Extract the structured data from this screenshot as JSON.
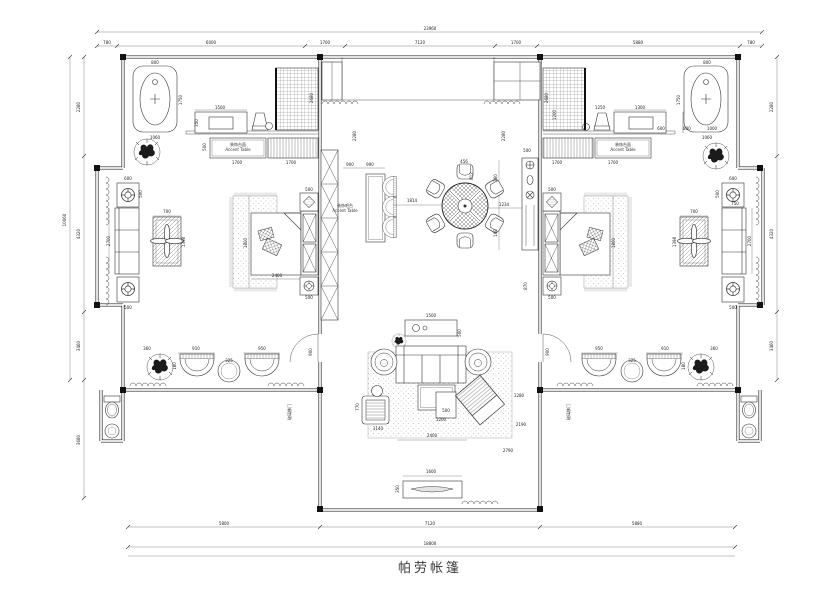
{
  "title": {
    "text": "帕劳帐篷"
  },
  "colors": {
    "ink": "#1c1c1c",
    "dim_text": "#222"
  },
  "annotations": [
    {
      "t": "23960",
      "x": 430,
      "y": 30
    },
    {
      "t": "780",
      "x": 107,
      "y": 44
    },
    {
      "t": "6000",
      "x": 211,
      "y": 44
    },
    {
      "t": "1700",
      "x": 325,
      "y": 44
    },
    {
      "t": "7120",
      "x": 420,
      "y": 44
    },
    {
      "t": "1700",
      "x": 516,
      "y": 44
    },
    {
      "t": "5880",
      "x": 638,
      "y": 44
    },
    {
      "t": "780",
      "x": 751,
      "y": 44
    },
    {
      "t": "5800",
      "x": 224,
      "y": 525
    },
    {
      "t": "7120",
      "x": 430,
      "y": 525
    },
    {
      "t": "5880",
      "x": 637,
      "y": 525
    },
    {
      "t": "18800",
      "x": 430,
      "y": 545
    },
    {
      "t": "10060",
      "x": 66,
      "y": 220,
      "r": -90
    },
    {
      "t": "2280",
      "x": 80,
      "y": 107,
      "r": -90
    },
    {
      "t": "4320",
      "x": 80,
      "y": 234,
      "r": -90
    },
    {
      "t": "3460",
      "x": 80,
      "y": 346,
      "r": -90
    },
    {
      "t": "3680",
      "x": 80,
      "y": 440,
      "r": -90
    },
    {
      "t": "2280",
      "x": 773,
      "y": 107,
      "r": -90
    },
    {
      "t": "4320",
      "x": 773,
      "y": 234,
      "r": -90
    },
    {
      "t": "3460",
      "x": 773,
      "y": 346,
      "r": -90
    },
    {
      "t": "800",
      "x": 155,
      "y": 64
    },
    {
      "t": "1750",
      "x": 182,
      "y": 100,
      "r": -90
    },
    {
      "t": "1060",
      "x": 155,
      "y": 139
    },
    {
      "t": "1500",
      "x": 220,
      "y": 109
    },
    {
      "t": "350",
      "x": 198,
      "y": 123,
      "r": -90
    },
    {
      "t": "2680",
      "x": 313,
      "y": 98,
      "r": -90
    },
    {
      "t": "500",
      "x": 206,
      "y": 147,
      "r": -90
    },
    {
      "t": "1700",
      "x": 237,
      "y": 164
    },
    {
      "t": "1700",
      "x": 291,
      "y": 164
    },
    {
      "t": "装饰台面",
      "x": 238,
      "y": 146,
      "s": 4,
      "c": "lbl"
    },
    {
      "t": "Accent Table",
      "x": 238,
      "y": 151,
      "s": 3.2,
      "c": "lbl"
    },
    {
      "t": "800",
      "x": 707,
      "y": 64
    },
    {
      "t": "1750",
      "x": 680,
      "y": 100,
      "r": -90
    },
    {
      "t": "1060",
      "x": 707,
      "y": 139
    },
    {
      "t": "1300",
      "x": 640,
      "y": 109
    },
    {
      "t": "1250",
      "x": 600,
      "y": 109
    },
    {
      "t": "600",
      "x": 661,
      "y": 130
    },
    {
      "t": "800",
      "x": 687,
      "y": 130
    },
    {
      "t": "1000",
      "x": 712,
      "y": 130
    },
    {
      "t": "2680",
      "x": 548,
      "y": 98,
      "r": -90
    },
    {
      "t": "1200",
      "x": 556,
      "y": 115,
      "r": -90
    },
    {
      "t": "1700",
      "x": 557,
      "y": 164
    },
    {
      "t": "1700",
      "x": 613,
      "y": 164
    },
    {
      "t": "装饰台面",
      "x": 623,
      "y": 146,
      "s": 4,
      "c": "lbl"
    },
    {
      "t": "Accent Table",
      "x": 623,
      "y": 151,
      "s": 3.2,
      "c": "lbl"
    },
    {
      "t": "500",
      "x": 309,
      "y": 191
    },
    {
      "t": "500",
      "x": 309,
      "y": 299
    },
    {
      "t": "1800",
      "x": 247,
      "y": 243,
      "r": -90
    },
    {
      "t": "2400",
      "x": 277,
      "y": 277
    },
    {
      "t": "500",
      "x": 552,
      "y": 191
    },
    {
      "t": "500",
      "x": 552,
      "y": 299
    },
    {
      "t": "1800",
      "x": 615,
      "y": 243,
      "r": -90
    },
    {
      "t": "870",
      "x": 527,
      "y": 286,
      "r": -90
    },
    {
      "t": "2280",
      "x": 356,
      "y": 136,
      "r": -90
    },
    {
      "t": "2280",
      "x": 505,
      "y": 136,
      "r": -90
    },
    {
      "t": "900",
      "x": 350,
      "y": 166
    },
    {
      "t": "990",
      "x": 370,
      "y": 166
    },
    {
      "t": "1814",
      "x": 412,
      "y": 202
    },
    {
      "t": "456",
      "x": 464,
      "y": 163
    },
    {
      "t": "812",
      "x": 473,
      "y": 176,
      "r": -90
    },
    {
      "t": "500",
      "x": 527,
      "y": 152
    },
    {
      "t": "160",
      "x": 497,
      "y": 178,
      "r": -90
    },
    {
      "t": "1234",
      "x": 504,
      "y": 206
    },
    {
      "t": "160",
      "x": 497,
      "y": 233,
      "r": -90
    },
    {
      "t": "装饰吧台",
      "x": 345,
      "y": 207,
      "s": 3.5,
      "c": "lbl"
    },
    {
      "t": "Accent Table",
      "x": 345,
      "y": 212,
      "s": 3,
      "c": "lbl"
    },
    {
      "t": "1500",
      "x": 431,
      "y": 317
    },
    {
      "t": "500",
      "x": 461,
      "y": 333,
      "r": -90
    },
    {
      "t": "1200",
      "x": 441,
      "y": 421
    },
    {
      "t": "500",
      "x": 446,
      "y": 412
    },
    {
      "t": "2400",
      "x": 432,
      "y": 437
    },
    {
      "t": "2190",
      "x": 521,
      "y": 426
    },
    {
      "t": "1280",
      "x": 519,
      "y": 397
    },
    {
      "t": "2790",
      "x": 508,
      "y": 452
    },
    {
      "t": "770",
      "x": 359,
      "y": 407,
      "r": -90
    },
    {
      "t": "1140",
      "x": 378,
      "y": 430
    },
    {
      "t": "1600",
      "x": 431,
      "y": 473
    },
    {
      "t": "350",
      "x": 399,
      "y": 489,
      "r": -90
    },
    {
      "t": "360",
      "x": 147,
      "y": 350
    },
    {
      "t": "910",
      "x": 196,
      "y": 350
    },
    {
      "t": "950",
      "x": 262,
      "y": 350
    },
    {
      "t": "325",
      "x": 229,
      "y": 362
    },
    {
      "t": "180",
      "x": 176,
      "y": 366,
      "r": -90
    },
    {
      "t": "900",
      "x": 312,
      "y": 352,
      "r": -90
    },
    {
      "t": "玻璃移门",
      "x": 291,
      "y": 412,
      "r": -90,
      "s": 3.5,
      "c": "lbl"
    },
    {
      "t": "360",
      "x": 714,
      "y": 350
    },
    {
      "t": "910",
      "x": 665,
      "y": 350
    },
    {
      "t": "950",
      "x": 599,
      "y": 350
    },
    {
      "t": "325",
      "x": 632,
      "y": 362
    },
    {
      "t": "180",
      "x": 685,
      "y": 366,
      "r": -90
    },
    {
      "t": "900",
      "x": 549,
      "y": 352,
      "r": -90
    },
    {
      "t": "玻璃移门",
      "x": 570,
      "y": 412,
      "r": -90,
      "s": 3.5,
      "c": "lbl"
    },
    {
      "t": "600",
      "x": 128,
      "y": 180
    },
    {
      "t": "500",
      "x": 142,
      "y": 194,
      "r": -90
    },
    {
      "t": "2700",
      "x": 110,
      "y": 241,
      "r": -90
    },
    {
      "t": "500",
      "x": 128,
      "y": 309
    },
    {
      "t": "700",
      "x": 167,
      "y": 213
    },
    {
      "t": "1398",
      "x": 185,
      "y": 242,
      "r": -90
    },
    {
      "t": "600",
      "x": 733,
      "y": 180
    },
    {
      "t": "500",
      "x": 719,
      "y": 194,
      "r": -90
    },
    {
      "t": "2700",
      "x": 751,
      "y": 241,
      "r": -90
    },
    {
      "t": "500",
      "x": 733,
      "y": 309
    },
    {
      "t": "750",
      "x": 735,
      "y": 205
    },
    {
      "t": "700",
      "x": 694,
      "y": 213
    },
    {
      "t": "1398",
      "x": 676,
      "y": 242,
      "r": -90
    }
  ]
}
